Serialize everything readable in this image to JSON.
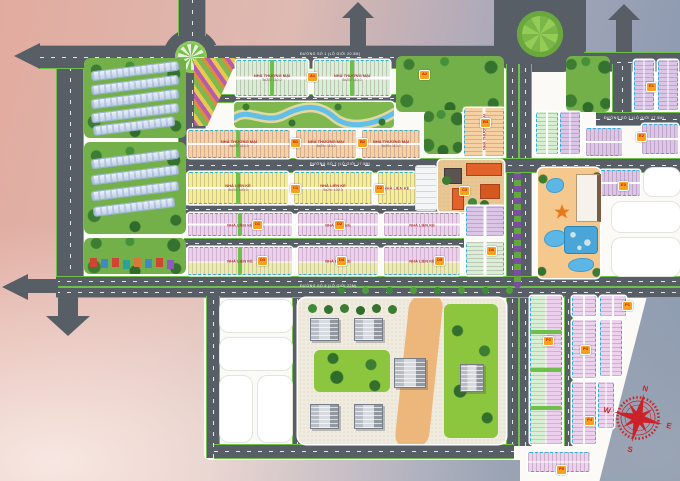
{
  "labels": {
    "commercial": "NHÀ THƯƠNG MẠI",
    "commercial_dims": "5x20= 110.0",
    "townhouse": "NHÀ LIỀN KỀ",
    "townhouse_dims": "5x20= 100.0"
  },
  "roads": {
    "r1": "ĐƯỜNG SỐ 1 (LỘ GIỚI 20.5M)",
    "r2": "ĐƯỜNG SỐ 2 (LỘ GIỚI 17.5M)",
    "r3": "ĐƯỜNG SỐ 7 (LỘ GIỚI 17.5M)",
    "r4": "ĐƯỜNG SỐ 9 (LỘ GIỚI 22M)"
  },
  "markers": [
    {
      "code": "A1"
    },
    {
      "code": "A2"
    },
    {
      "code": "B1"
    },
    {
      "code": "B2"
    },
    {
      "code": "B3"
    },
    {
      "code": "C1"
    },
    {
      "code": "C2"
    },
    {
      "code": "C3"
    },
    {
      "code": "D1"
    },
    {
      "code": "D2"
    },
    {
      "code": "D3"
    },
    {
      "code": "D4"
    },
    {
      "code": "D5"
    },
    {
      "code": "D6"
    },
    {
      "code": "E1"
    },
    {
      "code": "E2"
    },
    {
      "code": "E3"
    },
    {
      "code": "P1"
    },
    {
      "code": "P2"
    },
    {
      "code": "P3"
    },
    {
      "code": "P4"
    },
    {
      "code": "P5"
    }
  ],
  "compass": {
    "n": "N",
    "e": "E",
    "s": "S",
    "w": "W"
  }
}
